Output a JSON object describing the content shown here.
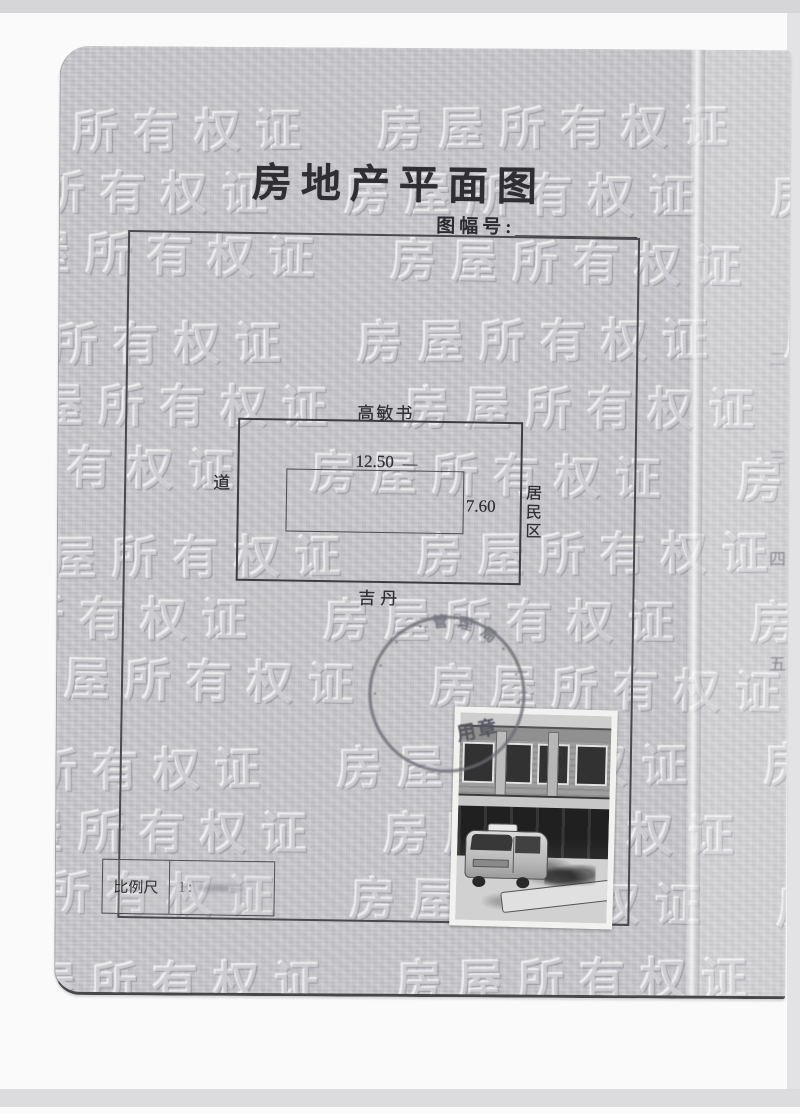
{
  "document": {
    "title": "房地产平面图",
    "sheet_no_label": "图幅号:",
    "sheet_no_value": ""
  },
  "plan": {
    "top_neighbor": "高敏书",
    "left_neighbor": "道",
    "right_neighbor": "居民区",
    "bottom_neighbor": "吉丹",
    "width_dimension": "12.50",
    "depth_dimension": "7.60"
  },
  "scale_box": {
    "label": "比例尺",
    "value": "1:"
  },
  "stamp": {
    "arc_text_legible": "管理局",
    "overlay_text": "用章",
    "ink_color": "#5d5d68"
  },
  "margin_numbers": [
    "二",
    "三",
    "四",
    "五"
  ],
  "watermark": {
    "text": "房屋所有权证"
  },
  "photo": {
    "alt": "two-storey storefront building with a minivan parked in snow"
  },
  "colors": {
    "page_background": "#c9c9cd",
    "ink": "#2e2e33",
    "seal_ink": "#6a6a74",
    "watermark": "#d8d8dc"
  }
}
